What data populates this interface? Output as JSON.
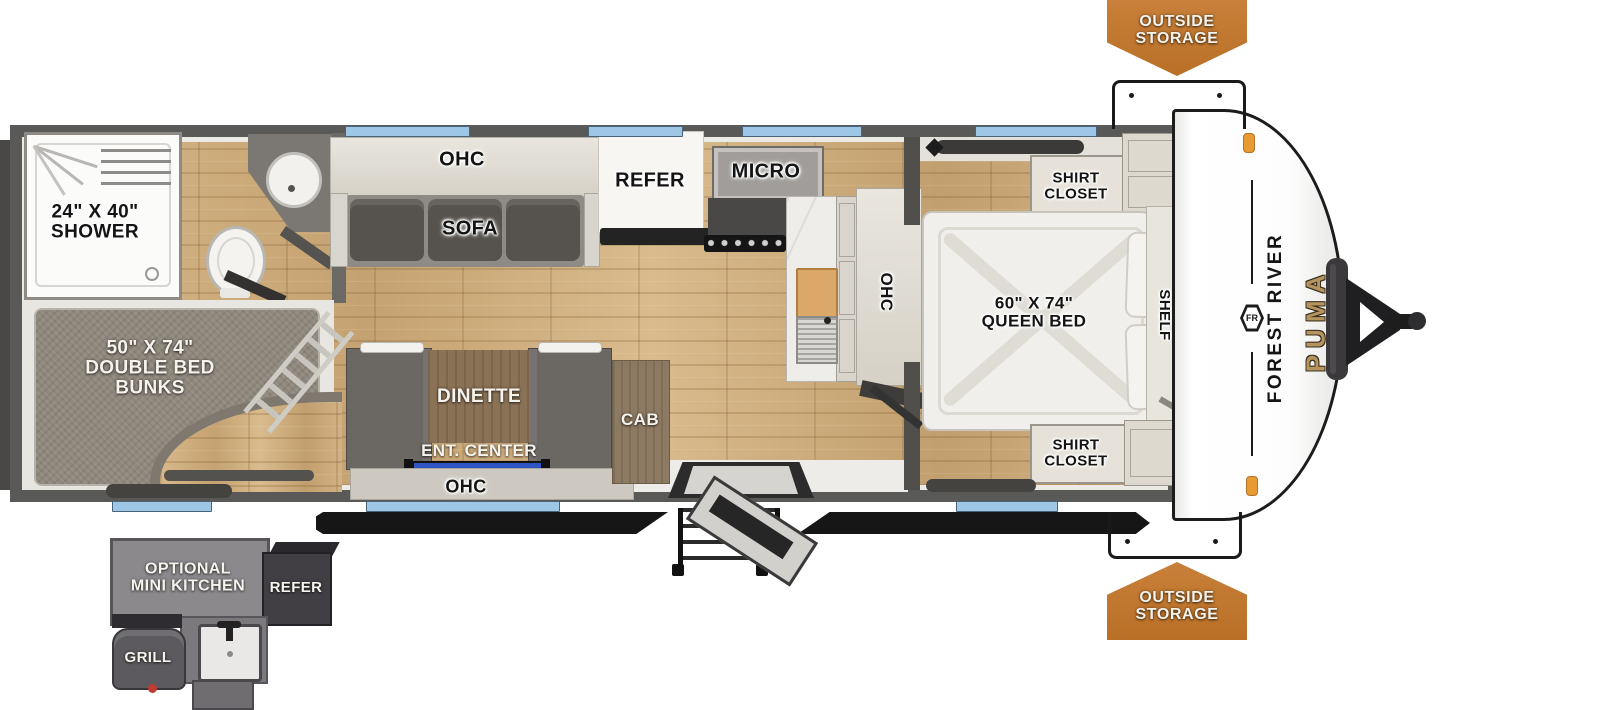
{
  "colors": {
    "badge_orange": "#bf762c",
    "window_blue": "#9ec7e6",
    "puma_gold": "#b5945f",
    "wall_gray": "#595957",
    "tv_blue": "#3056c8"
  },
  "badges": {
    "top": {
      "line1": "OUTSIDE",
      "line2": "STORAGE"
    },
    "bottom": {
      "line1": "OUTSIDE",
      "line2": "STORAGE"
    }
  },
  "front_cap": {
    "manufacturer": "FOREST RIVER",
    "logo": "FR",
    "model": "PUMA"
  },
  "bathroom": {
    "shower": {
      "line1": "24\" X 40\"",
      "line2": "SHOWER"
    }
  },
  "bunk_room": {
    "bunks": {
      "line1": "50\" X 74\"",
      "line2": "DOUBLE BED",
      "line3": "BUNKS"
    }
  },
  "living": {
    "ohc_top": "OHC",
    "sofa": "SOFA",
    "dinette": "DINETTE",
    "ent_center": "ENT. CENTER",
    "ohc_bottom": "OHC",
    "cab": "CAB"
  },
  "kitchen": {
    "refer": "REFER",
    "micro": "MICRO",
    "ohc_side": "OHC"
  },
  "bedroom": {
    "shirt_closet_top": {
      "line1": "SHIRT",
      "line2": "CLOSET"
    },
    "queen_bed": {
      "line1": "60\" X 74\"",
      "line2": "QUEEN BED"
    },
    "shelf": "SHELF",
    "shirt_closet_bottom": {
      "line1": "SHIRT",
      "line2": "CLOSET"
    }
  },
  "mini_kitchen": {
    "title": {
      "line1": "OPTIONAL",
      "line2": "MINI KITCHEN"
    },
    "refer": "REFER",
    "grill": "GRILL"
  }
}
